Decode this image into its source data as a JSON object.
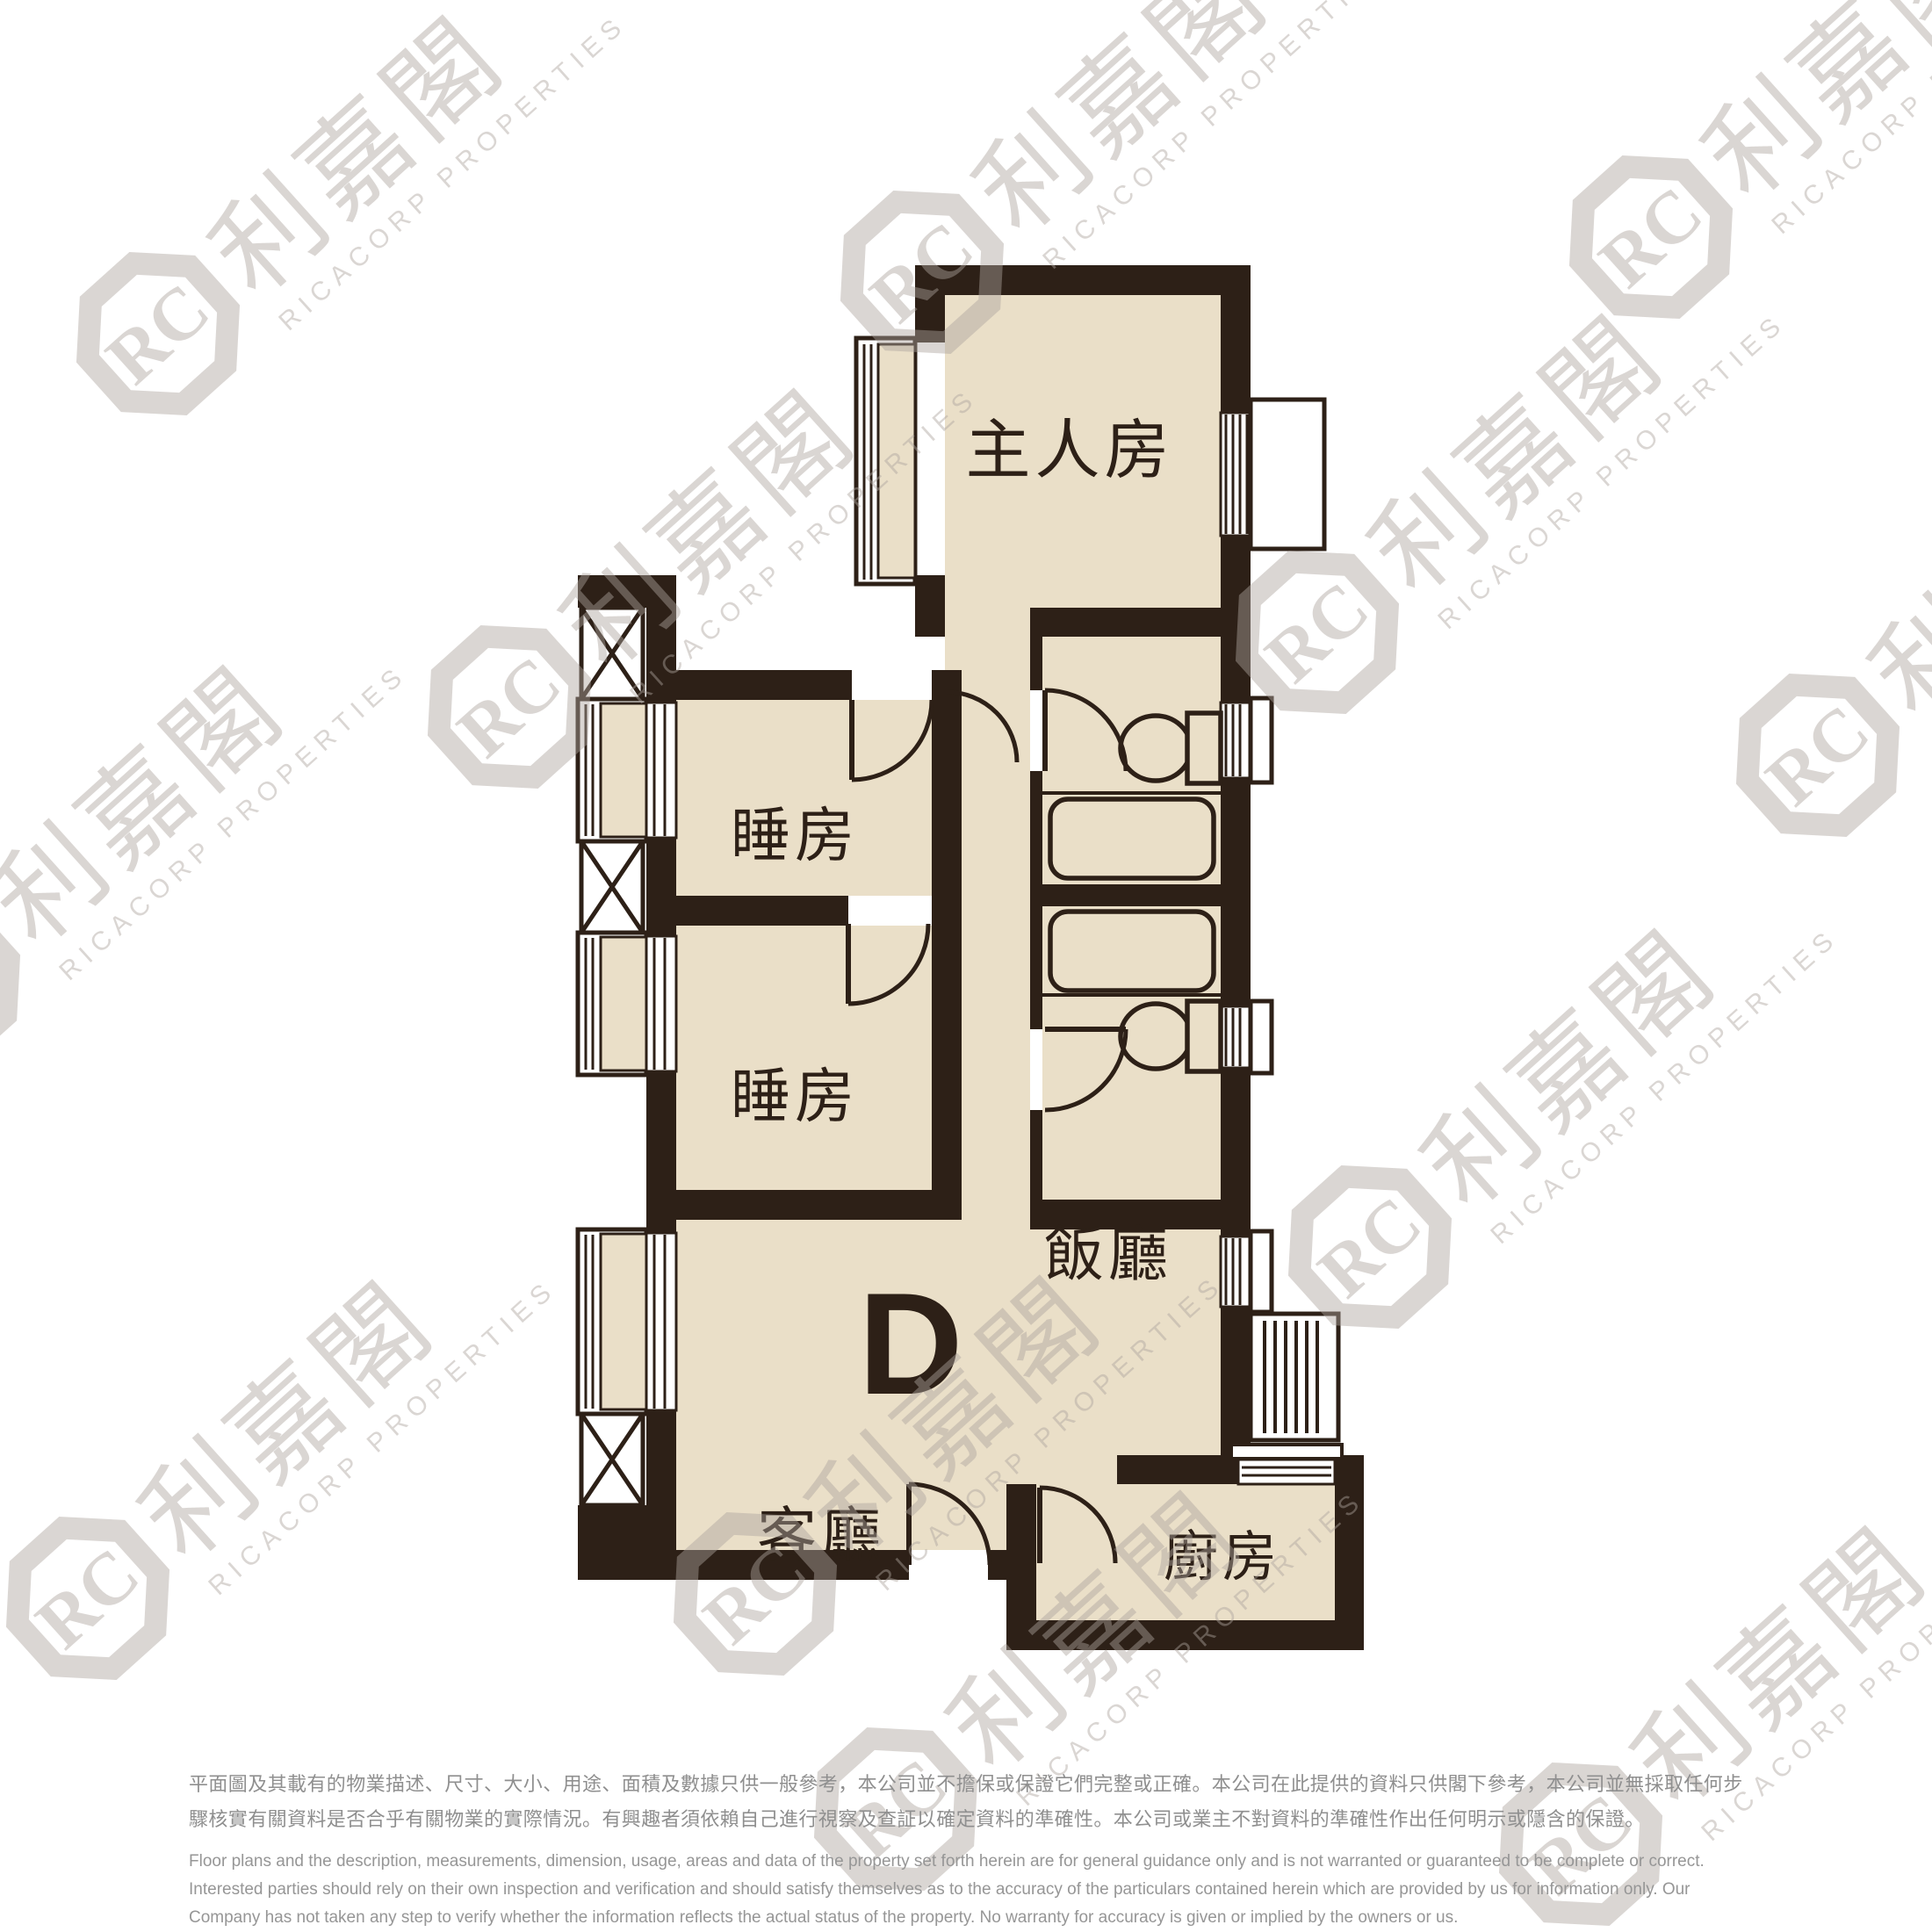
{
  "unit_label": "D",
  "rooms": {
    "master_bedroom": "主人房",
    "bedroom1": "睡房",
    "bedroom2": "睡房",
    "dining_room": "飯廳",
    "living_room": "客廳",
    "kitchen": "廚房"
  },
  "watermark": {
    "logo_text": "RC",
    "brand_zh": "利嘉閣",
    "brand_en": "RICACORP PROPERTIES"
  },
  "disclaimer": {
    "zh_lines": [
      "平面圖及其載有的物業描述、尺寸、大小、用途、面積及數據只供一般參考，本公司並不擔保或保證它們完整或正確。本公司在此提供的資料只供閣下參考，本公司並無採取任何步",
      "驟核實有關資料是否合乎有關物業的實際情況。有興趣者須依賴自己進行視察及查証以確定資料的準確性。本公司或業主不對資料的準確性作出任何明示或隱含的保證。"
    ],
    "en_lines": [
      "Floor plans and the description, measurements, dimension, usage, areas and data of the property set forth herein are for general guidance only and is not warranted or guaranteed to be complete or correct.",
      "Interested parties should rely on their own inspection and verification and should satisfy themselves as to the accuracy of the particulars contained herein which are provided by us for information only.  Our",
      "Company has not taken any step to verify whether the information reflects the actual status of the property.  No warranty for accuracy is given or implied by the owners or us."
    ]
  },
  "colors": {
    "wall": "#2d2017",
    "floor": "#eadfc8",
    "fixture_stroke": "#2d2017",
    "disclaimer_zh": "#8f8f8f",
    "disclaimer_en": "#969696",
    "watermark": "rgba(172,165,157,0.45)"
  }
}
